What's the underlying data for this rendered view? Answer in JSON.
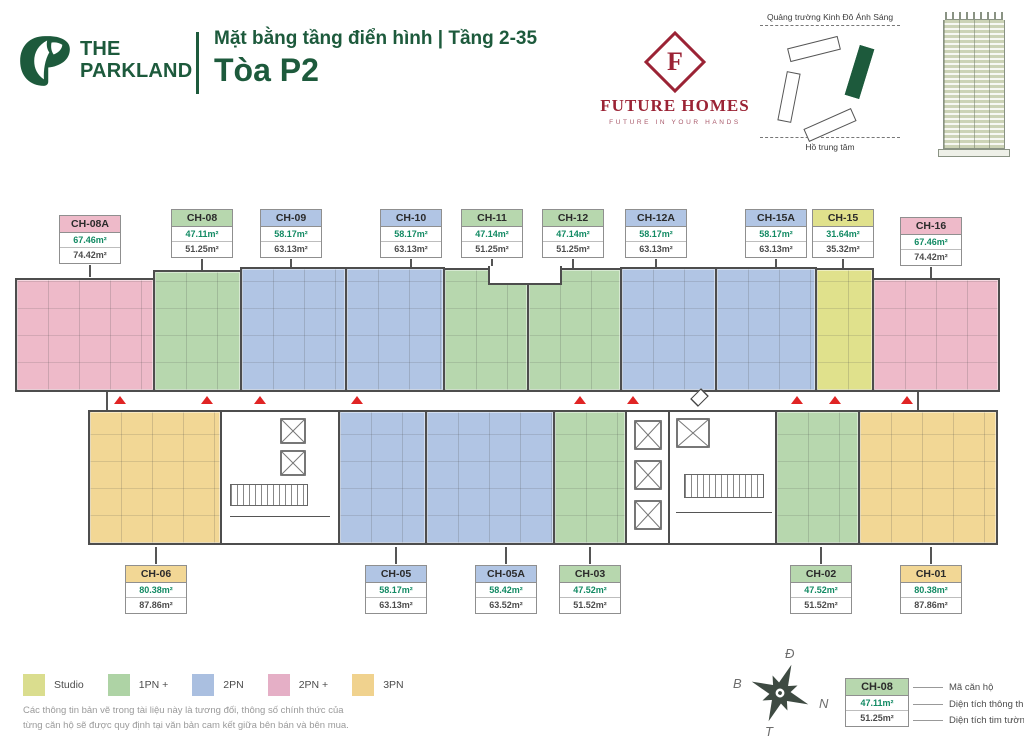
{
  "header": {
    "brand_line1": "THE",
    "brand_line2": "PARKLAND",
    "subtitle": "Mặt bằng tầng điển hình | Tầng 2-35",
    "title": "Tòa P2"
  },
  "future_homes": {
    "letter": "F",
    "name": "FUTURE HOMES",
    "tagline": "FUTURE IN YOUR HANDS"
  },
  "site_map": {
    "top_label": "Quảng trường Kinh Đô Ánh Sáng",
    "bottom_label": "Hồ trung tâm"
  },
  "units_top": [
    {
      "id": "CH-08A",
      "type": "2PN +",
      "area_net": "67.46m²",
      "area_gross": "74.42m²"
    },
    {
      "id": "CH-08",
      "type": "1PN +",
      "area_net": "47.11m²",
      "area_gross": "51.25m²"
    },
    {
      "id": "CH-09",
      "type": "2PN",
      "area_net": "58.17m²",
      "area_gross": "63.13m²"
    },
    {
      "id": "CH-10",
      "type": "2PN",
      "area_net": "58.17m²",
      "area_gross": "63.13m²"
    },
    {
      "id": "CH-11",
      "type": "1PN +",
      "area_net": "47.14m²",
      "area_gross": "51.25m²"
    },
    {
      "id": "CH-12",
      "type": "1PN +",
      "area_net": "47.14m²",
      "area_gross": "51.25m²"
    },
    {
      "id": "CH-12A",
      "type": "2PN",
      "area_net": "58.17m²",
      "area_gross": "63.13m²"
    },
    {
      "id": "CH-15A",
      "type": "2PN",
      "area_net": "58.17m²",
      "area_gross": "63.13m²"
    },
    {
      "id": "CH-15",
      "type": "Studio",
      "area_net": "31.64m²",
      "area_gross": "35.32m²"
    },
    {
      "id": "CH-16",
      "type": "2PN +",
      "area_net": "67.46m²",
      "area_gross": "74.42m²"
    }
  ],
  "units_bottom": [
    {
      "id": "CH-06",
      "type": "3PN",
      "area_net": "80.38m²",
      "area_gross": "87.86m²"
    },
    {
      "id": "CH-05",
      "type": "2PN",
      "area_net": "58.17m²",
      "area_gross": "63.13m²"
    },
    {
      "id": "CH-05A",
      "type": "2PN",
      "area_net": "58.42m²",
      "area_gross": "63.52m²"
    },
    {
      "id": "CH-03",
      "type": "1PN +",
      "area_net": "47.52m²",
      "area_gross": "51.52m²"
    },
    {
      "id": "CH-02",
      "type": "1PN +",
      "area_net": "47.52m²",
      "area_gross": "51.52m²"
    },
    {
      "id": "CH-01",
      "type": "3PN",
      "area_net": "80.38m²",
      "area_gross": "87.86m²"
    }
  ],
  "legend": {
    "items": [
      {
        "label": "Studio",
        "color": "#dadd8e"
      },
      {
        "label": "1PN +",
        "color": "#aed3a5"
      },
      {
        "label": "2PN",
        "color": "#aabfe0"
      },
      {
        "label": "2PN +",
        "color": "#e5afc6"
      },
      {
        "label": "3PN",
        "color": "#f0d28e"
      }
    ]
  },
  "disclaimer": "Các thông tin bản vẽ trong tài liệu này là tương đối, thông số chính thức của từng căn hộ sẽ được quy định tại văn bản cam kết giữa bên bán và bên mua.",
  "compass": {
    "top": "Đ",
    "left": "B",
    "right": "N",
    "bottom": "T"
  },
  "key": {
    "code": "CH-08",
    "area_net": "47.11m²",
    "area_gross": "51.25m²",
    "label_code": "Mã căn hộ",
    "label_area_net": "Diện tích thông thủy",
    "label_area_gross": "Diện tích tim tường"
  },
  "colors": {
    "brand_green": "#1d5a3c",
    "maroon": "#9b2335",
    "entrance_red": "#e02424",
    "area_value_green": "#128a63"
  }
}
